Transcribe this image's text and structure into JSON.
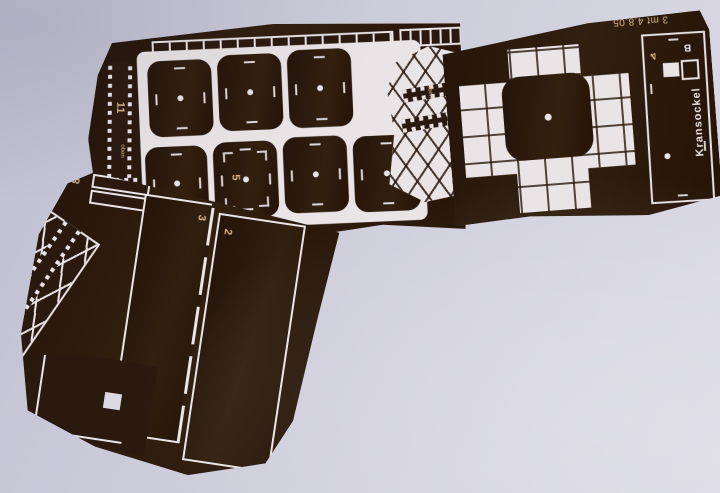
{
  "photo": {
    "subject": "Photo-etched model sheet for a crane pedestal lying on a light surface",
    "surface_color": "#cdccdb",
    "sheet_color": "#2a190e",
    "etch_color": "#eae4e6",
    "marking_color": "#d9b489"
  },
  "markings": {
    "edge_note": "3 mt 4.8.05",
    "title": "Kransockel",
    "orientation": "oben",
    "strip11": "11",
    "strip12": "12",
    "part8": "8",
    "panel3": "3",
    "panel2": "2",
    "disc5": "5",
    "box4": "4",
    "boxB": "B"
  }
}
